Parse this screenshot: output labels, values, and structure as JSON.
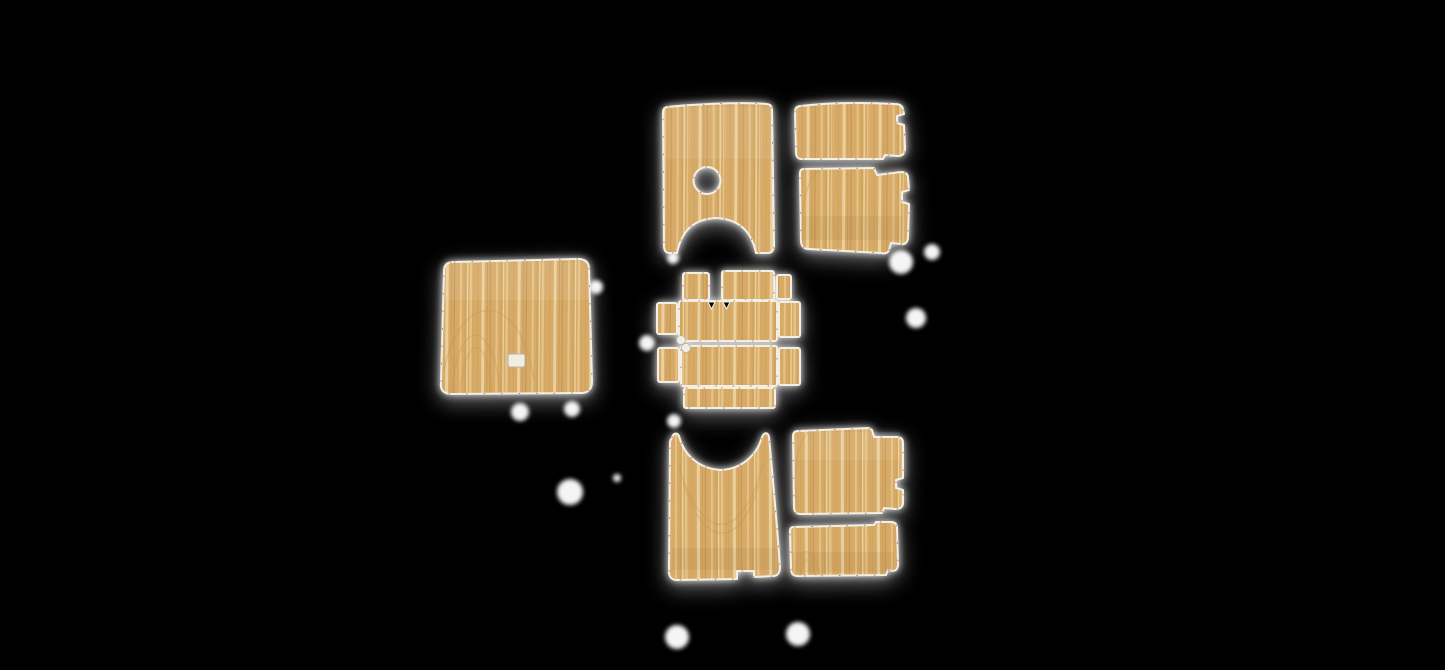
{
  "canvas": {
    "background": "#000000"
  },
  "palette": {
    "background": "#000000",
    "wood_base": "#d7aa68",
    "stripe_light": "#e9cb93",
    "stripe_pale": "#f0dcae",
    "stripe_mid": "#cfa158",
    "stripe_dark": "#c2944e",
    "edge_trim": "#f4efe5",
    "edge_speck": "#7d3512",
    "glow": "#ffffff",
    "cutout_fill": "#f2ede2",
    "cutout_border": "#b9b3a6"
  },
  "pieces": [
    {
      "id": "front-floor-mat-left",
      "label": "wood-grain front floor mat with round shifter hole and arch cutout"
    },
    {
      "id": "side-mat-upper-right",
      "label": "wood-grain upper right side mat"
    },
    {
      "id": "side-mat-lower-right",
      "label": "wood-grain lower right side mat with edge notch"
    },
    {
      "id": "engine-cover-mat",
      "label": "large wood-grain engine cover mat with small latch cutout"
    },
    {
      "id": "console-mat-set",
      "label": "center console wood-grain mat pieces"
    },
    {
      "id": "rear-floor-mat-left",
      "label": "wood-grain rear floor mat with arch cutout and bottom notch"
    },
    {
      "id": "rear-side-mat-upper-right",
      "label": "wood-grain upper right rear side mat with edge notch"
    },
    {
      "id": "rear-side-mat-lower-right",
      "label": "wood-grain lower right rear side mat"
    }
  ],
  "console_subpieces": [
    "tab-small-left",
    "tab-wide-center",
    "tab-small-right",
    "wing-left-upper",
    "band-upper",
    "wing-right-upper",
    "wing-left-lower",
    "band-lower",
    "wing-right-lower",
    "tab-bottom"
  ]
}
